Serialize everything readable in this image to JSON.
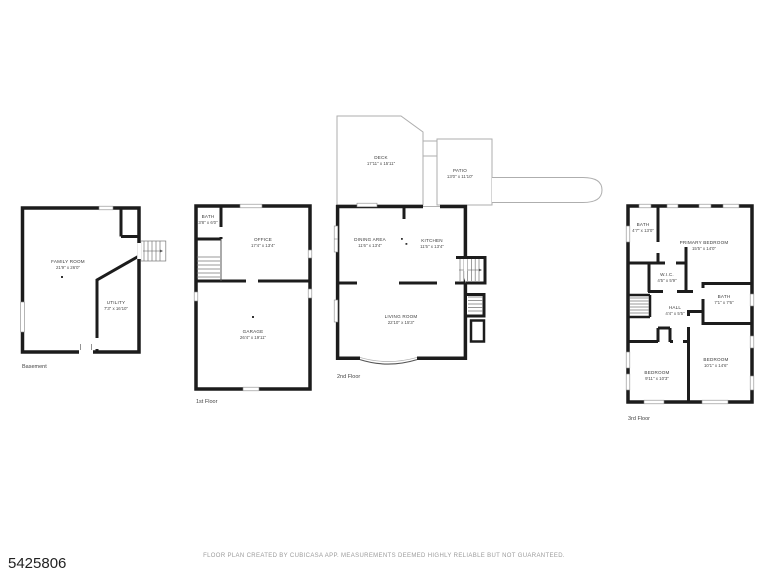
{
  "page": {
    "listing_id": "5425806",
    "footer_disclaimer": "FLOOR PLAN CREATED BY CUBICASA APP. MEASUREMENTS DEEMED HIGHLY RELIABLE BUT NOT GUARANTEED."
  },
  "colors": {
    "wall": "#1c1c1c",
    "light_outline": "#aeaeae",
    "label_text": "#3a3a3a",
    "footer_text": "#9b9b9b"
  },
  "floors": {
    "basement": {
      "label": "Basement",
      "rooms": {
        "family_room": {
          "name": "FAMILY ROOM",
          "dims": "21'9\" x 26'0\""
        },
        "utility": {
          "name": "UTILITY",
          "dims": "7'3\" x 16'10\""
        }
      }
    },
    "first": {
      "label": "1st Floor",
      "rooms": {
        "bath": {
          "name": "BATH",
          "dims": "3'8\" x 6'0\""
        },
        "office": {
          "name": "OFFICE",
          "dims": "17'4\" x 13'4\""
        },
        "garage": {
          "name": "GARAGE",
          "dims": "26'4\" x 19'11\""
        }
      }
    },
    "second": {
      "label": "2nd Floor",
      "rooms": {
        "deck": {
          "name": "DECK",
          "dims": "17'11\" x 15'11\""
        },
        "patio": {
          "name": "PATIO",
          "dims": "13'0\" x 11'10\""
        },
        "dining_area": {
          "name": "DINING AREA",
          "dims": "11'6\" x 13'4\""
        },
        "kitchen": {
          "name": "KITCHEN",
          "dims": "11'5\" x 13'4\""
        },
        "living_room": {
          "name": "LIVING ROOM",
          "dims": "22'10\" x 15'3\""
        }
      }
    },
    "third": {
      "label": "3rd Floor",
      "rooms": {
        "bath_upper": {
          "name": "BATH",
          "dims": "4'7\" x 13'0\""
        },
        "primary_bedroom": {
          "name": "PRIMARY BEDROOM",
          "dims": "15'5\" x 14'0\""
        },
        "wic": {
          "name": "W.I.C.",
          "dims": "4'5\" x 5'9\""
        },
        "hall": {
          "name": "HALL",
          "dims": "4'4\" x 5'5\""
        },
        "bath_middle": {
          "name": "BATH",
          "dims": "7'1\" x 7'6\""
        },
        "bedroom_left": {
          "name": "BEDROOM",
          "dims": "9'11\" x 10'3\""
        },
        "bedroom_right": {
          "name": "BEDROOM",
          "dims": "10'1\" x 14'6\""
        }
      }
    }
  }
}
